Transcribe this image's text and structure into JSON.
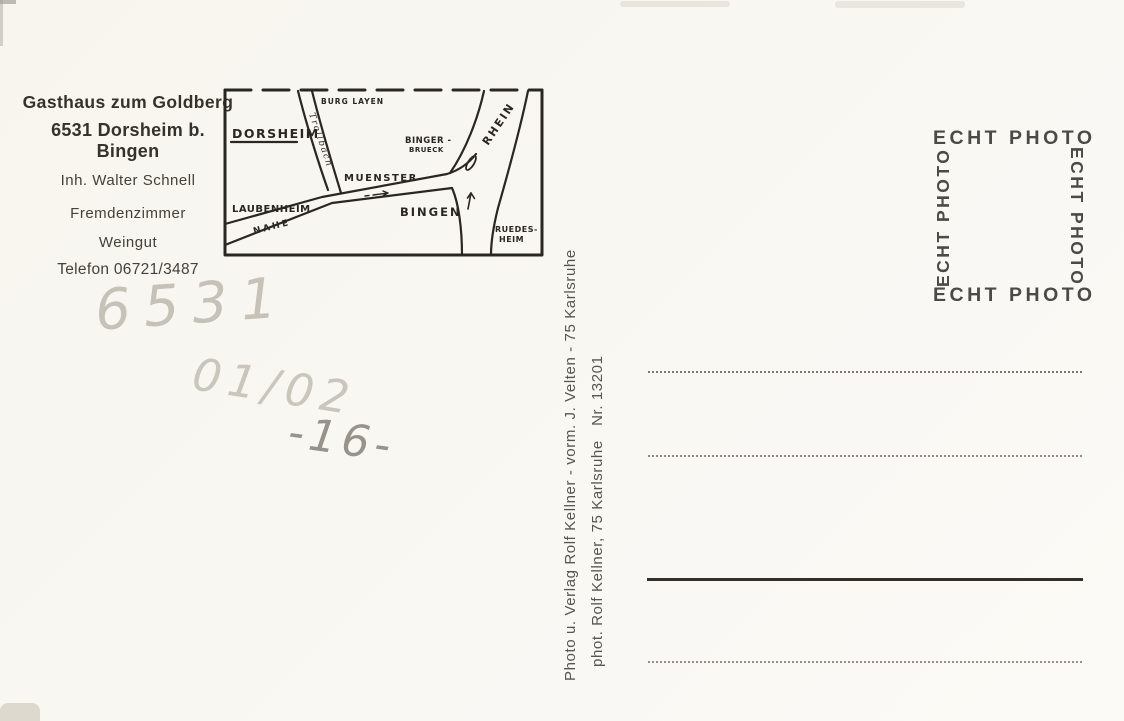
{
  "colors": {
    "paper": "#f8f6f0",
    "ink": "#2a2723",
    "pencil": "#c7c2b7",
    "publisher_gray": "#57554f",
    "stamp_gray": "#4c4a47"
  },
  "business": {
    "name": "Gasthaus zum Goldberg",
    "address": "6531 Dorsheim b. Bingen",
    "owner": "Inh. Walter Schnell",
    "service1": "Fremdenzimmer",
    "service2": "Weingut",
    "phone": "Telefon 06721/3487"
  },
  "map": {
    "labels": {
      "dorsheim": "DORSHEIM",
      "burg_layen": "BURG LAYEN",
      "trollbach": "Trollbach",
      "muenster": "MUENSTER",
      "bingerbrueck_line1": "BINGER -",
      "bingerbrueck_line2": "BRUECK",
      "rhein": "RHEIN",
      "laubenheim": "LAUBENHEIM",
      "nahe": "NAHE",
      "bingen": "BINGEN",
      "ruedesheim_line1": "RUEDES-",
      "ruedesheim_line2": "HEIM"
    }
  },
  "handwriting": {
    "postal_code": "6531",
    "note1": "01/02",
    "note2": "-16-"
  },
  "publisher": {
    "line1": "Photo u. Verlag Rolf Kellner - vorm. J. Velten - 75 Karlsruhe",
    "line2": "phot. Rolf Kellner, 75 Karlsruhe   Nr. 13201"
  },
  "stamp": {
    "label": "ECHT PHOTO"
  }
}
